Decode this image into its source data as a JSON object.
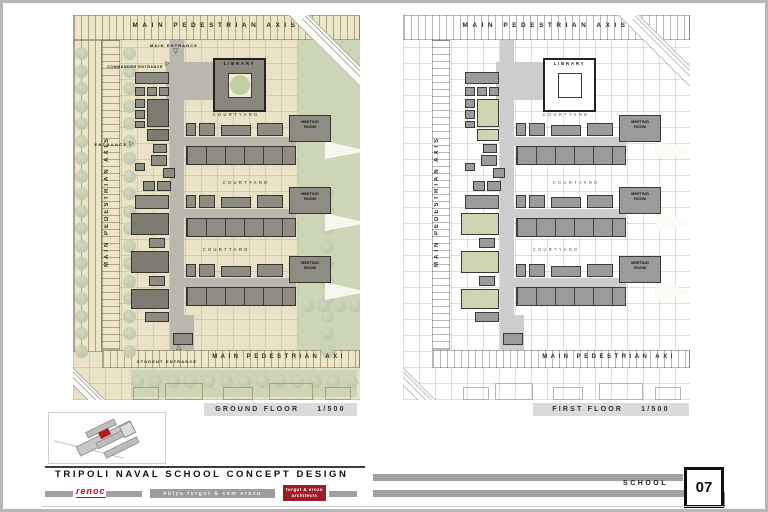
{
  "sheet": {
    "title": "TRIPOLI NAVAL SCHOOL CONCEPT DESIGN",
    "category_label": "SCHOOL",
    "sheet_number": "07",
    "logo_text": "renoc",
    "credit_text": "hülya turgut & cem erozu",
    "badge_line1": "turgut & erozu",
    "badge_line2": "architects"
  },
  "icons": {
    "main_entrance_marker": "▽",
    "commander_entrance_marker": "▷",
    "side_entrance_marker": "▷",
    "student_entrance_marker": "△"
  },
  "colors": {
    "accent_red": "#b01b28",
    "bar_gray": "#a2a2a2",
    "plan_paper": "#e9e2c6",
    "landscape_green": "#ccd5b6",
    "building_gray": "#8f8d83"
  },
  "plans": {
    "ground": {
      "caption_name": "GROUND FLOOR",
      "caption_scale": "1/500",
      "axis_top": "MAIN PEDESTRIAN AXIS",
      "axis_left": "MAIN PEDESTRIAN AXIS",
      "axis_bottom": "MAIN PEDESTRIAN AXI",
      "labels": {
        "library": "LIBRARY",
        "courtyard": "COURTYARD",
        "meeting_room": "MEETING ROOM",
        "main_entrance": "MAIN ENTRANCE",
        "commander_entrance": "COMMANDER ENTRANCE",
        "side_entrance": "ENTRANCE",
        "student_entrance": "STUDENT ENTRANCE"
      }
    },
    "first": {
      "caption_name": "FIRST FLOOR",
      "caption_scale": "1/500",
      "axis_top": "MAIN PEDESTRIAN AXIS",
      "axis_left": "MAIN PEDESTRIAN AXIS",
      "axis_bottom": "MAIN PEDESTRIAN AXI",
      "labels": {
        "library": "LIBRARY",
        "courtyard": "COURTYARD",
        "meeting_room": "MEETING ROOM"
      }
    }
  }
}
